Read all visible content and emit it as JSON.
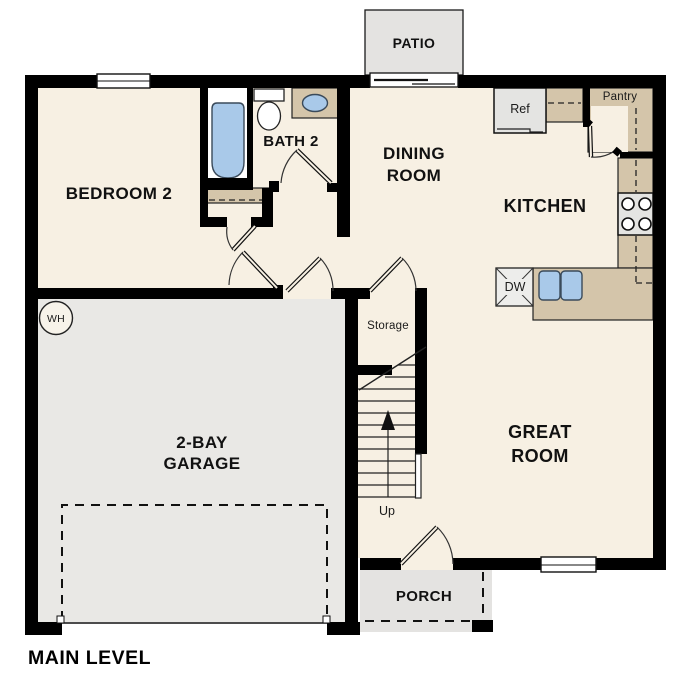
{
  "title": "MAIN LEVEL",
  "rooms": {
    "bedroom2": "BEDROOM 2",
    "bath2": "BATH 2",
    "dining_line1": "DINING",
    "dining_line2": "ROOM",
    "kitchen": "KITCHEN",
    "great_line1": "GREAT",
    "great_line2": "ROOM",
    "garage_line1": "2-BAY",
    "garage_line2": "GARAGE",
    "patio": "PATIO",
    "porch": "PORCH",
    "storage": "Storage"
  },
  "fixtures": {
    "refrigerator": "Ref",
    "pantry": "Pantry",
    "dishwasher": "DW",
    "water_heater": "WH",
    "stairs_direction": "Up"
  },
  "colors": {
    "floor": "#f7f0e3",
    "garage": "#e9e8e5",
    "outdoor": "#e4e3e1",
    "counter": "#d4c5aa",
    "fixture_blue": "#a9c9e9",
    "wall": "#000000"
  }
}
